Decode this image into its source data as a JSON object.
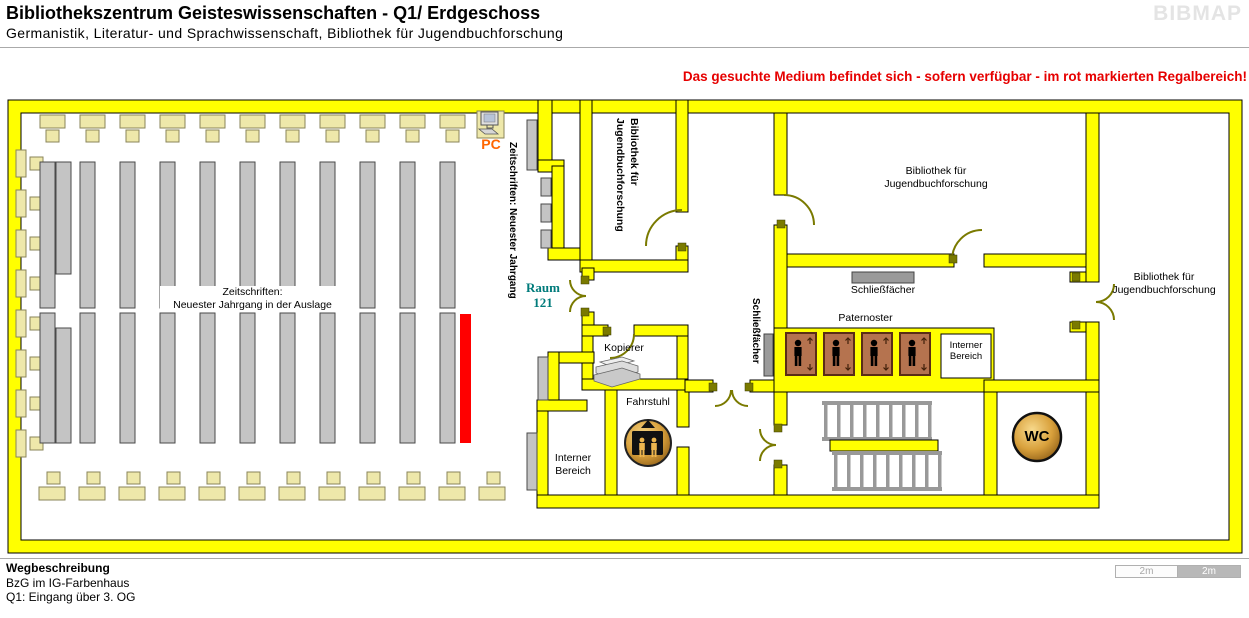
{
  "header": {
    "title": "Bibliothekszentrum Geisteswissenschaften - Q1/ Erdgeschoss",
    "subtitle": "Germanistik, Literatur- und Sprachwissenschaft, Bibliothek für Jugendbuchforschung",
    "brand": "BIBMAP"
  },
  "notice": "Das gesuchte Medium befindet sich - sofern verfügbar -  im rot markierten Regalbereich!",
  "map": {
    "rooms": {
      "jugendbuch_vertical": "Bibliothek für\nJugendbuchforschung",
      "jugendbuch_center": "Bibliothek für\nJugendbuchforschung",
      "jugendbuch_right": "Bibliothek für\nJugendbuchforschung",
      "raum_121": "Raum\n121",
      "interner_bereich_links": "Interner\nBereich",
      "interner_bereich_rechts": "Interner\nBereich"
    },
    "features": {
      "zeitschriften_auslage": "Zeitschriften:\nNeuester Jahrgang in der Auslage",
      "zeitschriften_regal": "Zeitschriften: Neuester Jahrgang",
      "pc": "PC",
      "kopierer": "Kopierer",
      "fahrstuhl": "Fahrstuhl",
      "paternoster": "Paternoster",
      "schliessfaecher_oben": "Schließfächer",
      "schliessfaecher_seite": "Schließfächer",
      "wc": "WC"
    },
    "scale": {
      "segment1": "2m",
      "segment2": "2m"
    },
    "colors": {
      "wall": "#ffff00",
      "highlight_shelf": "#ff0000",
      "furniture": "#eee8aa",
      "shelf": "#c4c4c4",
      "door_arc": "#7a7a00",
      "paternoster_box": "#b5734f",
      "notice_text": "#e60000",
      "room_number_text": "#007b7b",
      "pc_text": "#ff6600",
      "brand_text": "#e4e4e4"
    }
  },
  "footer": {
    "heading": "Wegbeschreibung",
    "line1": "BzG im IG-Farbenhaus",
    "line2": "Q1: Eingang über 3. OG"
  }
}
